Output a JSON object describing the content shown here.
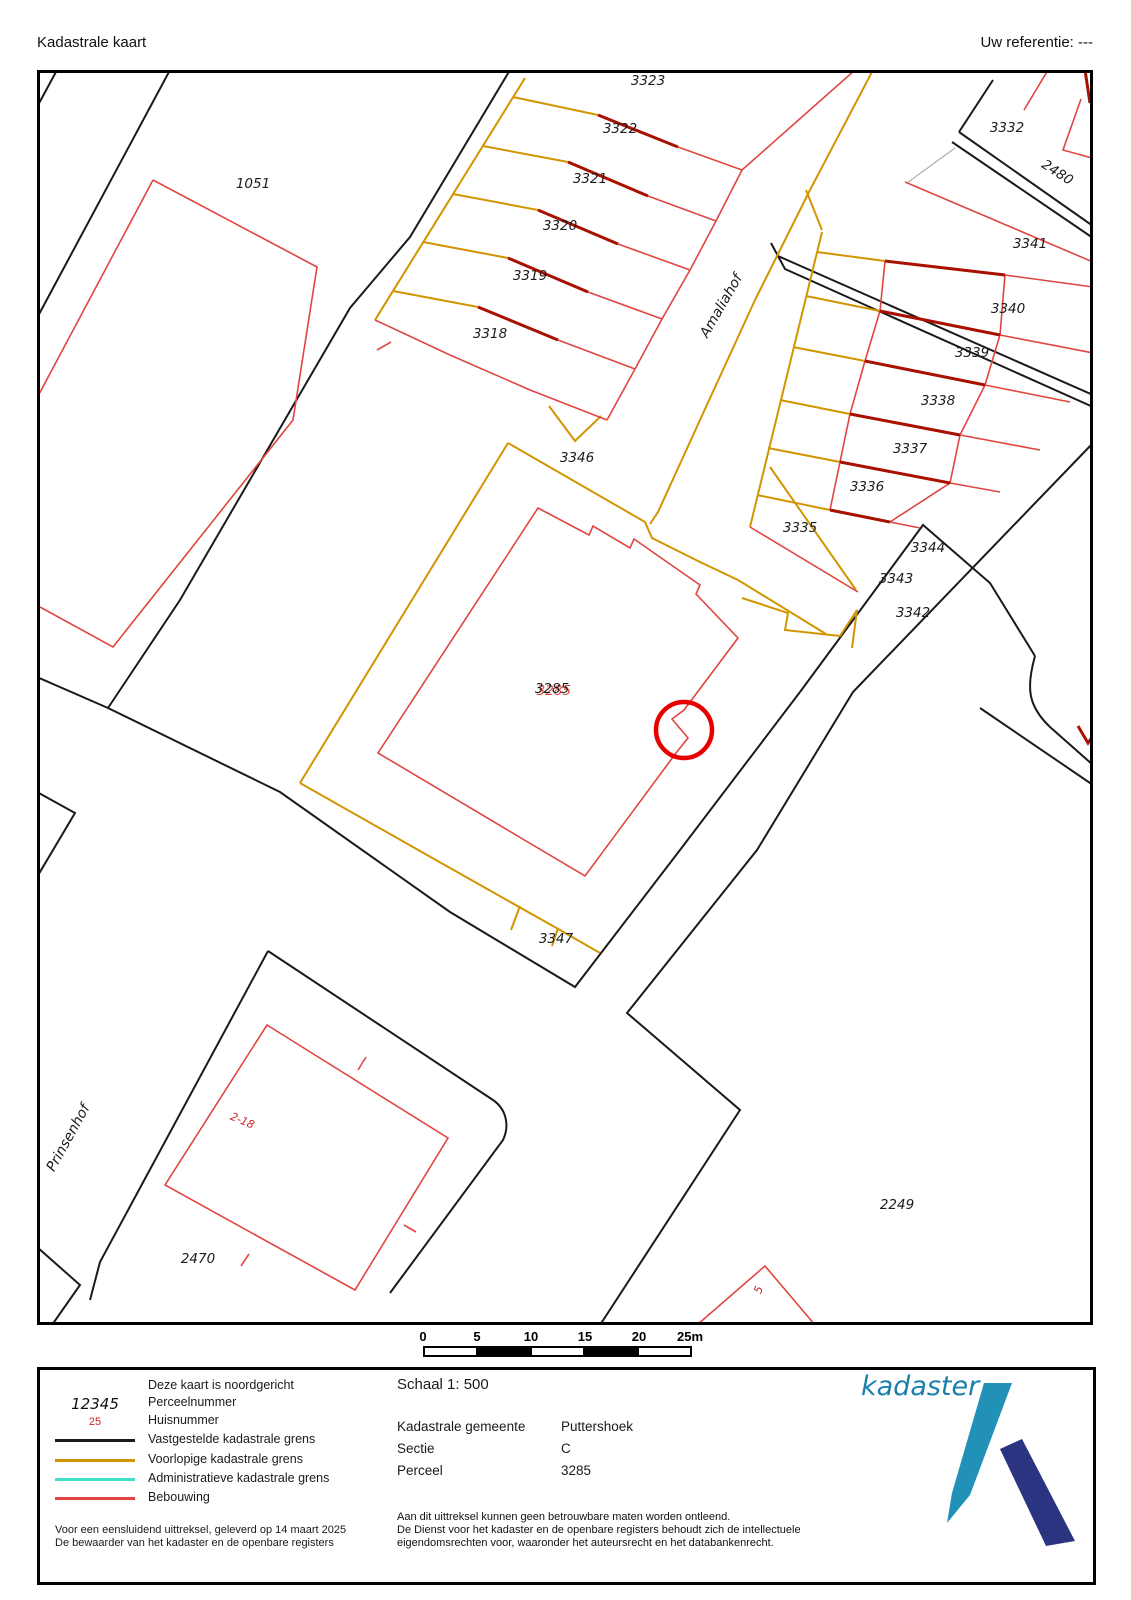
{
  "header": {
    "title": "Kadastrale kaart",
    "reference": "Uw referentie: ---"
  },
  "map": {
    "colors": {
      "established_boundary": "#1a1a1a",
      "provisional_boundary": "#d29500",
      "administrative_boundary": "#3fe0c8",
      "building": "#e04540",
      "building_wall": "#a81000",
      "highlight_circle": "#e60000"
    },
    "labels": [
      {
        "name": "parcel-1051",
        "text": "1051",
        "x": 253,
        "y": 188,
        "kind": "parcel"
      },
      {
        "name": "parcel-3323",
        "text": "3323",
        "x": 648,
        "y": 85,
        "kind": "parcel"
      },
      {
        "name": "parcel-3322",
        "text": "3322",
        "x": 620,
        "y": 133,
        "kind": "parcel"
      },
      {
        "name": "parcel-3321",
        "text": "3321",
        "x": 590,
        "y": 183,
        "kind": "parcel"
      },
      {
        "name": "parcel-3320",
        "text": "3320",
        "x": 560,
        "y": 230,
        "kind": "parcel"
      },
      {
        "name": "parcel-3319",
        "text": "3319",
        "x": 530,
        "y": 280,
        "kind": "parcel"
      },
      {
        "name": "parcel-3318",
        "text": "3318",
        "x": 490,
        "y": 338,
        "kind": "parcel"
      },
      {
        "name": "parcel-3332",
        "text": "3332",
        "x": 1007,
        "y": 132,
        "kind": "parcel"
      },
      {
        "name": "parcel-2480",
        "text": "2480",
        "x": 1055,
        "y": 176,
        "rot": 33,
        "kind": "parcel"
      },
      {
        "name": "parcel-3341",
        "text": "3341",
        "x": 1030,
        "y": 248,
        "kind": "parcel"
      },
      {
        "name": "parcel-3340",
        "text": "3340",
        "x": 1008,
        "y": 313,
        "kind": "parcel"
      },
      {
        "name": "parcel-3339",
        "text": "3339",
        "x": 972,
        "y": 357,
        "kind": "parcel"
      },
      {
        "name": "parcel-3338",
        "text": "3338",
        "x": 938,
        "y": 405,
        "kind": "parcel"
      },
      {
        "name": "parcel-3337",
        "text": "3337",
        "x": 910,
        "y": 453,
        "kind": "parcel"
      },
      {
        "name": "parcel-3336",
        "text": "3336",
        "x": 867,
        "y": 491,
        "kind": "parcel"
      },
      {
        "name": "parcel-3335",
        "text": "3335",
        "x": 800,
        "y": 532,
        "kind": "parcel"
      },
      {
        "name": "parcel-3344",
        "text": "3344",
        "x": 928,
        "y": 552,
        "kind": "parcel"
      },
      {
        "name": "parcel-3343",
        "text": "3343",
        "x": 896,
        "y": 583,
        "kind": "parcel"
      },
      {
        "name": "parcel-3342",
        "text": "3342",
        "x": 913,
        "y": 617,
        "kind": "parcel"
      },
      {
        "name": "parcel-3346",
        "text": "3346",
        "x": 577,
        "y": 462,
        "kind": "parcel"
      },
      {
        "name": "parcel-3285",
        "text": "3285",
        "x": 552,
        "y": 693,
        "kind": "focus"
      },
      {
        "name": "parcel-3347",
        "text": "3347",
        "x": 556,
        "y": 943,
        "kind": "parcel"
      },
      {
        "name": "parcel-2470",
        "text": "2470",
        "x": 198,
        "y": 1263,
        "kind": "parcel"
      },
      {
        "name": "parcel-2249",
        "text": "2249",
        "x": 897,
        "y": 1209,
        "kind": "parcel"
      },
      {
        "name": "street-amaliahof",
        "text": "Amaliahof",
        "x": 725,
        "y": 308,
        "rot": -60,
        "kind": "street"
      },
      {
        "name": "street-prinsenhof",
        "text": "Prinsenhof",
        "x": 72,
        "y": 1140,
        "rot": -61,
        "kind": "street"
      },
      {
        "name": "house-2-18",
        "text": "2-18",
        "x": 241,
        "y": 1124,
        "rot": 23,
        "kind": "house"
      },
      {
        "name": "house-5",
        "text": "5",
        "x": 762,
        "y": 1291,
        "rot": -70,
        "kind": "house"
      }
    ]
  },
  "scalebar": {
    "ticks": [
      "0",
      "5",
      "10",
      "15",
      "20",
      "25m"
    ],
    "tick_x": [
      423,
      477,
      531,
      585,
      639,
      690
    ]
  },
  "legend": {
    "north_note": "Deze kaart is noordgericht",
    "items": [
      {
        "symbol": "12345",
        "symbol_kind": "perceel",
        "label": "Perceelnummer"
      },
      {
        "symbol": "25",
        "symbol_kind": "huis",
        "label": "Huisnummer"
      },
      {
        "color": "#1a1a1a",
        "label": "Vastgestelde kadastrale grens"
      },
      {
        "color": "#d29500",
        "label": "Voorlopige kadastrale grens"
      },
      {
        "color": "#3fe0c8",
        "label": "Administratieve kadastrale grens"
      },
      {
        "color": "#e04540",
        "label": "Bebouwing"
      }
    ],
    "footnote1": "Voor een eensluidend uittreksel, geleverd op 14 maart 2025",
    "footnote2": "De bewaarder van het kadaster en de openbare registers"
  },
  "details": {
    "schaal": "Schaal 1: 500",
    "rows": [
      {
        "label": "Kadastrale gemeente",
        "value": "Puttershoek"
      },
      {
        "label": "Sectie",
        "value": "C"
      },
      {
        "label": "Perceel",
        "value": "3285"
      }
    ],
    "disclaimer": [
      "Aan dit uittreksel kunnen geen betrouwbare maten worden ontleend.",
      "De Dienst voor het kadaster en de openbare registers behoudt zich de intellectuele",
      "eigendomsrechten voor, waaronder het auteursrecht en het databankenrecht."
    ]
  },
  "logo": {
    "wordmark": "kadaster"
  }
}
